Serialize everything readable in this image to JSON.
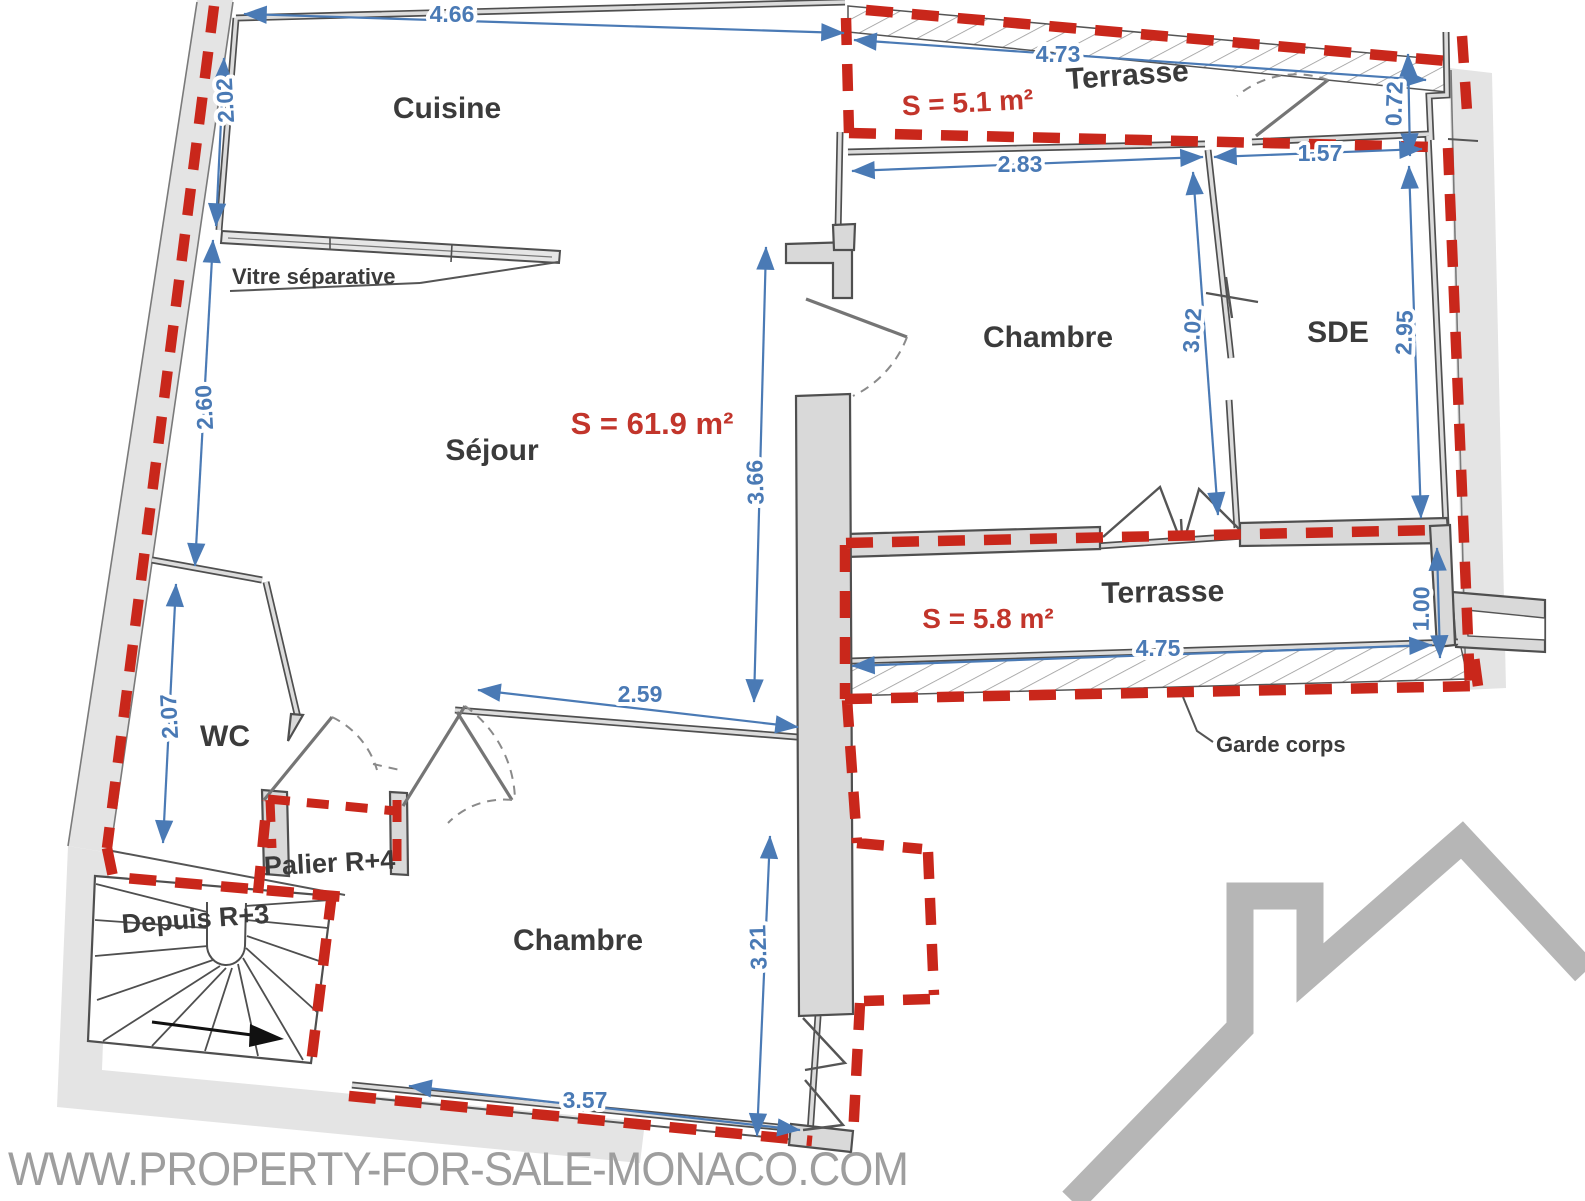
{
  "plan": {
    "rooms": {
      "cuisine": "Cuisine",
      "sejour": "Séjour",
      "chambre_top": "Chambre",
      "chambre_bottom": "Chambre",
      "sde": "SDE",
      "wc": "WC",
      "terrasse_top": "Terrasse",
      "terrasse_mid": "Terrasse",
      "palier": "Palier R+4",
      "depuis": "Depuis R+3"
    },
    "areas": {
      "sejour": "S = 61.9 m²",
      "terrasse_top": "S = 5.1 m²",
      "terrasse_mid": "S = 5.8 m²"
    },
    "annotations": {
      "vitre_separative": "Vitre séparative",
      "garde_corps": "Garde corps"
    },
    "dimensions": {
      "top_cuisine": "4.66",
      "left_upper": "2.02",
      "left_mid": "2.60",
      "left_lower": "2.07",
      "terrasse_top_width": "4.73",
      "terrasse_top_right": "0.72",
      "chambre_top_width": "2.83",
      "sde_width": "1.57",
      "chambre_top_height": "3.02",
      "sde_height": "2.95",
      "sejour_height": "3.66",
      "sejour_bottom": "2.59",
      "terrasse_mid_width": "4.75",
      "terrasse_mid_depth": "1.00",
      "chambre_bottom_height": "3.21",
      "chambre_bottom_width": "3.57"
    },
    "colors": {
      "boundary_red": "#c9271b",
      "dimension_blue": "#4a7ab5",
      "area_red": "#c2352b",
      "wall_dark": "#4f4f4f",
      "wall_fill": "#d9d9d9",
      "band_gray": "#e4e4e4",
      "label_gray": "#3b3b3b",
      "logo_gray": "#b6b6b6",
      "watermark_gray": "#9e9e9e"
    }
  },
  "watermark": "WWW.PROPERTY-FOR-SALE-MONACO.COM"
}
